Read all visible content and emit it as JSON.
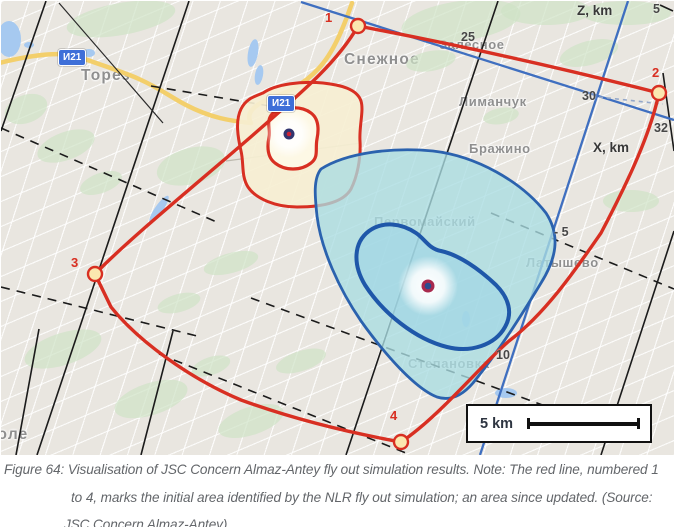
{
  "map": {
    "towns": [
      {
        "name": "Торез"
      },
      {
        "name": "Снежное"
      },
      {
        "name": "Залесное"
      },
      {
        "name": "Лиманчук"
      },
      {
        "name": "Бражино"
      },
      {
        "name": "Первомайский"
      },
      {
        "name": "Латышево"
      },
      {
        "name": "Степановка"
      },
      {
        "name": "поле"
      }
    ],
    "road_signs": [
      {
        "label": "И21"
      },
      {
        "label": "И21"
      }
    ],
    "axes": {
      "z_label": "Z, km",
      "x_label": "X, km"
    },
    "ticks": [
      {
        "v": "5"
      },
      {
        "v": "25"
      },
      {
        "v": "30"
      },
      {
        "v": "32"
      },
      {
        "v": "- 5"
      },
      {
        "v": "10"
      }
    ],
    "vertices": [
      {
        "n": "1"
      },
      {
        "n": "2"
      },
      {
        "n": "3"
      },
      {
        "n": "4"
      }
    ],
    "scale_bar": {
      "label": "5 km"
    },
    "colors": {
      "map_base": "#e9e6e0",
      "green_area": "#cfe2c6",
      "water": "#a6c9f0",
      "road_yellow": "#f3cf6b",
      "grid_black": "#1b1b1b",
      "sim_axis_blue": "#3f6fc0",
      "nlr_red": "#d82f22",
      "vertex_fill": "#fbe7af",
      "impact_cream_fill": "#f6efd2",
      "impact_teal_fill": "#a9dde2",
      "impact_blue_stroke": "#2b62ae",
      "label_gray": "#8f8f8f",
      "caption_gray": "#63666a",
      "sign_blue": "#3e6fd8"
    }
  },
  "figure": {
    "caption": {
      "line1": "Figure 64: Visualisation of JSC Concern Almaz-Antey fly out simulation results. Note: The red line, numbered 1",
      "line2": "to 4, marks the initial area identified by the NLR fly out simulation; an area since updated. (Source:",
      "line3": "JSC Concern Almaz-Antey)"
    }
  }
}
